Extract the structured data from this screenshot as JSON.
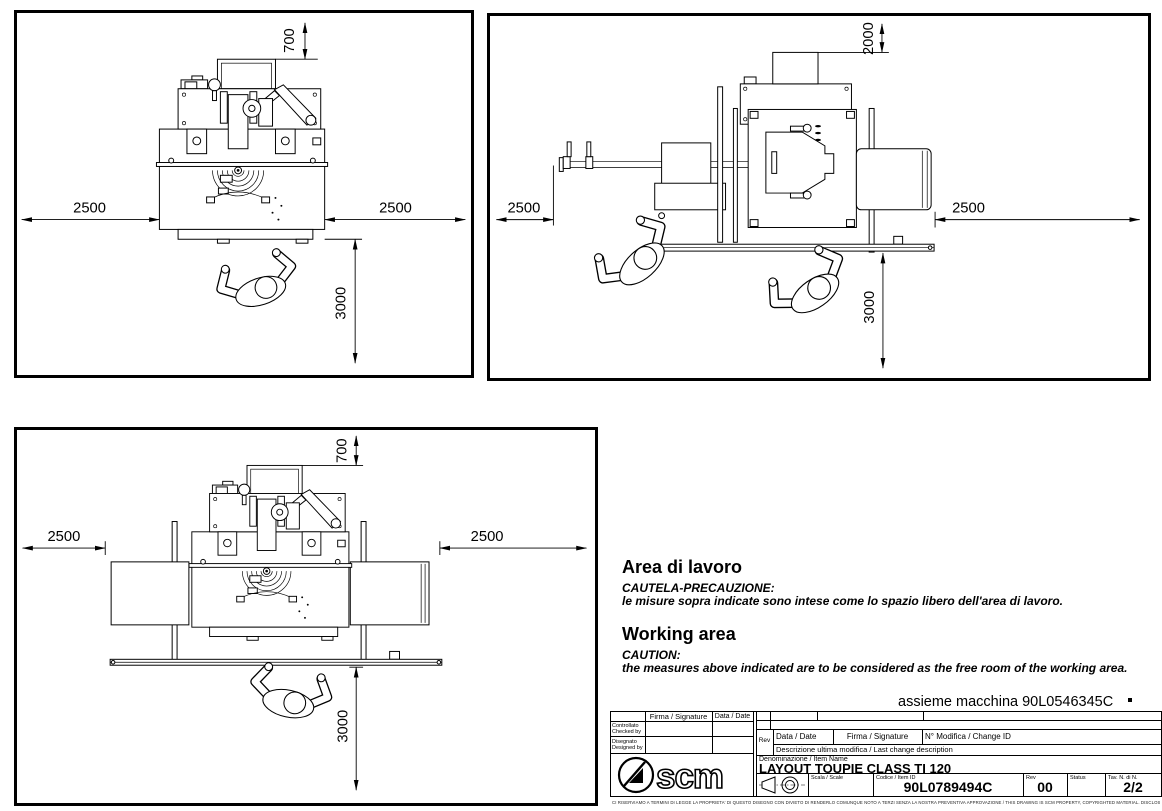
{
  "colors": {
    "ink": "#000000",
    "paper": "#ffffff"
  },
  "views": {
    "a": {
      "dim_top": "700",
      "dim_left": "2500",
      "dim_right": "2500",
      "dim_bottom": "3000"
    },
    "b": {
      "dim_top": "2000",
      "dim_left": "2500",
      "dim_right": "2500",
      "dim_bottom": "3000"
    },
    "c": {
      "dim_top": "700",
      "dim_left": "2500",
      "dim_right": "2500",
      "dim_bottom": "3000"
    }
  },
  "notes": {
    "it_title": "Area di lavoro",
    "it_caution": "CAUTELA-PRECAUZIONE:",
    "it_body": "le misure sopra indicate sono intese come lo spazio libero dell'area di lavoro.",
    "en_title": "Working area",
    "en_caution": "CAUTION:",
    "en_body": "the measures above indicated are to be considered as the free room of the working area."
  },
  "title_block": {
    "assembly_ref": "assieme macchina 90L0546345C",
    "firma_header": "Firma / Signature",
    "data_header": "Data / Date",
    "checked_it": "Controllato",
    "checked_en": "Checked by",
    "designed_it": "Disegnato",
    "designed_en": "Designed by",
    "rev_label": "Rev",
    "change_data_label": "Data / Date",
    "change_firma_label": "Firma / Signature",
    "change_id_label": "N° Modifica / Change ID",
    "change_desc_label": "Descrizione ultima modifica / Last change description",
    "item_name_label": "Denominazione / Item Name",
    "item_name": "LAYOUT TOUPIE CLASS TI 120",
    "scale_label": "Scala / Scale",
    "item_id_label": "Codice / Item ID",
    "item_id": "90L0789494C",
    "rev_col_label": "Rev",
    "rev_value": "00",
    "status_label": "Status",
    "sheet_label": "Tav. N. di N.",
    "sheet_value": "2/2",
    "logo_text": "scm"
  },
  "disclaimer": "CI RISERVIAMO A TERMINI DI LEGGE LA PROPRIETA' DI QUESTO DISEGNO CON DIVIETO DI RENDERLO COMUNQUE NOTO A TERZI SENZA LA NOSTRA PREVENTIVA APPROVAZIONE / THIS DRAWING IS SCM PROPERTY, COPYRIGHTED MATERIAL. DISCLOSURE TO THIRD PARTIES WITHOUT OUR AUTHORIZATION IS EXPLICITLY FORBIDDEN"
}
